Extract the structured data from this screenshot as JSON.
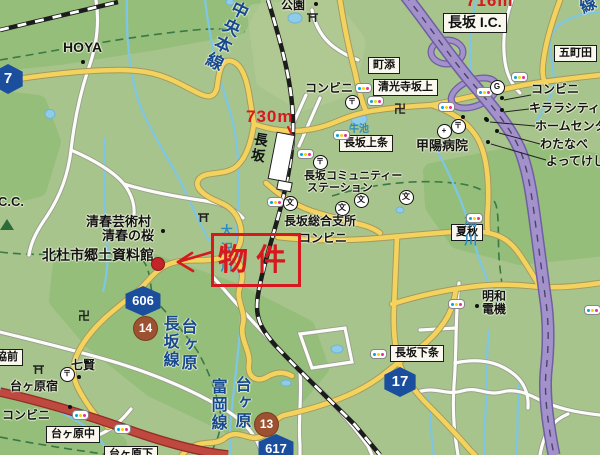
{
  "map": {
    "colors": {
      "land": "#a7c48c",
      "forest": "#8fbd76",
      "water": "#7ec6e6",
      "road_yellow": "#f3d35e",
      "road_red": "#c0493f",
      "highway_purple": "#a391cc",
      "rail_black": "#1c1c1c",
      "boundary_green": "#35753f",
      "shield_blue": "#1c4e9e",
      "badge_brown": "#9c5130",
      "annotation_red": "#d6181f"
    },
    "annotation": {
      "property_label": "物件",
      "distance_station": "730m",
      "distance_ic": "716m"
    },
    "railway": {
      "line_name": "中央本線",
      "station_name": "長坂"
    },
    "text_groups": [
      {
        "kind": "box",
        "cls": "m box-label",
        "name": "boxed-place-label",
        "items": [
          {
            "t": "長坂 I.C.",
            "x": 443,
            "y": 13,
            "fs": 14
          },
          {
            "t": "町添",
            "x": 368,
            "y": 57,
            "fs": 11
          },
          {
            "t": "清光寺坂上",
            "x": 373,
            "y": 79,
            "fs": 11
          },
          {
            "t": "五町田",
            "x": 554,
            "y": 45,
            "fs": 11
          },
          {
            "t": "長坂上条",
            "x": 339,
            "y": 135,
            "fs": 11
          },
          {
            "t": "夏秋",
            "x": 451,
            "y": 224,
            "fs": 11
          },
          {
            "t": "長坂下条",
            "x": 390,
            "y": 345,
            "fs": 11
          },
          {
            "t": "協前",
            "x": -9,
            "y": 349,
            "fs": 11
          },
          {
            "t": "台ヶ原中",
            "x": 46,
            "y": 426,
            "fs": 11
          },
          {
            "t": "台ヶ原下",
            "x": 104,
            "y": 446,
            "fs": 11
          }
        ]
      },
      {
        "kind": "label",
        "cls": "m plabel",
        "name": "place-label",
        "items": [
          {
            "t": "HOYA",
            "x": 63,
            "y": 40,
            "fs": 14
          },
          {
            "t": "公園",
            "x": 281,
            "y": -1,
            "fs": 12
          },
          {
            "t": "コンビニ",
            "x": 305,
            "y": 82,
            "fs": 12
          },
          {
            "t": "コンビニ",
            "x": 531,
            "y": 83,
            "fs": 12
          },
          {
            "t": "キララシティ",
            "x": 529,
            "y": 102,
            "fs": 12
          },
          {
            "t": "ホームセンタ",
            "x": 535,
            "y": 120,
            "fs": 12
          },
          {
            "t": "わたなべ",
            "x": 540,
            "y": 138,
            "fs": 12
          },
          {
            "t": "よってけし",
            "x": 546,
            "y": 155,
            "fs": 12
          },
          {
            "t": "甲陽病院",
            "x": 416,
            "y": 139,
            "fs": 13
          },
          {
            "t": "清春芸術村",
            "x": 86,
            "y": 215,
            "fs": 13
          },
          {
            "t": "清春の桜",
            "x": 102,
            "y": 229,
            "fs": 13
          },
          {
            "t": "北杜市郷土資料館",
            "x": 42,
            "y": 248,
            "fs": 14
          },
          {
            "t": "長坂コミュニティー",
            "x": 304,
            "y": 170,
            "fs": 11
          },
          {
            "t": "ステーション",
            "x": 307,
            "y": 182,
            "fs": 11
          },
          {
            "t": "長坂総合支所",
            "x": 284,
            "y": 215,
            "fs": 12
          },
          {
            "t": "コンビニ",
            "x": 299,
            "y": 232,
            "fs": 12
          },
          {
            "t": "明和",
            "x": 482,
            "y": 290,
            "fs": 12
          },
          {
            "t": "電機",
            "x": 482,
            "y": 303,
            "fs": 12
          },
          {
            "t": "七賢",
            "x": 71,
            "y": 359,
            "fs": 12
          },
          {
            "t": "台ヶ原宿",
            "x": 10,
            "y": 380,
            "fs": 12
          },
          {
            "t": "コンビニ",
            "x": 2,
            "y": 409,
            "fs": 12
          },
          {
            "t": "C.C.",
            "x": -2,
            "y": 195,
            "fs": 13
          }
        ]
      },
      {
        "kind": "vtext",
        "cls": "m vtext vroad",
        "name": "road-name-vertical",
        "items": [
          {
            "t": "長坂線",
            "x": 160,
            "y": 315,
            "fs": 16
          },
          {
            "t": "台ヶ原",
            "x": 178,
            "y": 318,
            "fs": 16
          },
          {
            "t": "富岡線",
            "x": 208,
            "y": 378,
            "fs": 16
          },
          {
            "t": "台ヶ原",
            "x": 232,
            "y": 376,
            "fs": 16
          },
          {
            "t": "泉線",
            "x": 566,
            "y": -14,
            "fs": 16,
            "rot": -26
          }
        ]
      },
      {
        "kind": "vtext",
        "cls": "m vtext vroad",
        "name": "railway-line-name",
        "items": [
          {
            "t": "中央本線",
            "x": 233,
            "y": -3,
            "fs": 17,
            "rot": 26
          }
        ]
      },
      {
        "kind": "vtext",
        "cls": "m vtext vwater",
        "name": "river-name",
        "items": [
          {
            "t": "大沢川",
            "x": 219,
            "y": 224,
            "fs": 12
          },
          {
            "t": "鳩川",
            "x": 462,
            "y": 214,
            "fs": 13
          }
        ]
      },
      {
        "kind": "label",
        "cls": "m hwater",
        "name": "pond-name",
        "items": [
          {
            "t": "牛池",
            "x": 349,
            "y": 124,
            "fs": 10
          }
        ]
      },
      {
        "kind": "label",
        "cls": "m red-label",
        "name": "distance-label",
        "items": [
          {
            "t": "730m",
            "x": 246,
            "y": 108,
            "fs": 17
          },
          {
            "t": "716m",
            "x": 466,
            "y": -8,
            "fs": 17
          }
        ]
      },
      {
        "kind": "shield",
        "cls": "m shield",
        "name": "route-shield",
        "items": [
          {
            "t": "7",
            "x": -8,
            "y": 64,
            "w": 32,
            "h": 30,
            "fs": 15
          },
          {
            "t": "606",
            "x": 124,
            "y": 286,
            "w": 38,
            "h": 30,
            "fs": 13
          },
          {
            "t": "617",
            "x": 257,
            "y": 434,
            "w": 38,
            "h": 30,
            "fs": 13
          },
          {
            "t": "17",
            "x": 383,
            "y": 367,
            "w": 34,
            "h": 30,
            "fs": 15
          }
        ]
      },
      {
        "kind": "badge",
        "cls": "m badge",
        "name": "route-badge",
        "items": [
          {
            "t": "14",
            "x": 133,
            "y": 316,
            "d": 23,
            "fs": 12
          },
          {
            "t": "13",
            "x": 254,
            "y": 412,
            "d": 23,
            "fs": 12
          }
        ]
      }
    ],
    "icons": {
      "traffic_lights": [
        [
          363,
          88
        ],
        [
          375,
          101
        ],
        [
          341,
          135
        ],
        [
          305,
          154
        ],
        [
          446,
          107
        ],
        [
          484,
          92
        ],
        [
          519,
          77
        ],
        [
          474,
          218
        ],
        [
          378,
          354
        ],
        [
          456,
          304
        ],
        [
          592,
          310
        ],
        [
          80,
          415
        ],
        [
          122,
          429
        ],
        [
          275,
          202
        ]
      ],
      "schools": [
        [
          290,
          203
        ],
        [
          342,
          208
        ],
        [
          361,
          200
        ],
        [
          406,
          197
        ]
      ],
      "school_glyph": "文",
      "post_offices": [
        [
          352,
          102
        ],
        [
          458,
          126
        ],
        [
          320,
          162
        ],
        [
          67,
          374
        ]
      ],
      "post_glyph": "〒",
      "hospital": [
        444,
        131
      ],
      "hospital_glyph": "+",
      "gas_station": [
        497,
        87
      ],
      "gas_glyph": "G",
      "manji": [
        [
          394,
          103
        ],
        [
          78,
          310
        ]
      ],
      "manji_glyph": "卍",
      "torii": [
        [
          306,
          10
        ],
        [
          197,
          210
        ],
        [
          32,
          362
        ]
      ],
      "poi_dots": [
        [
          83,
          62
        ],
        [
          316,
          4
        ],
        [
          163,
          231
        ],
        [
          477,
          306
        ],
        [
          79,
          377
        ],
        [
          70,
          407
        ],
        [
          502,
          98
        ],
        [
          502,
          110
        ],
        [
          487,
          120
        ],
        [
          497,
          131
        ],
        [
          488,
          142
        ],
        [
          463,
          117
        ],
        [
          486,
          119
        ]
      ],
      "property_dot": [
        158,
        264
      ],
      "mountain": [
        0,
        219
      ]
    }
  }
}
